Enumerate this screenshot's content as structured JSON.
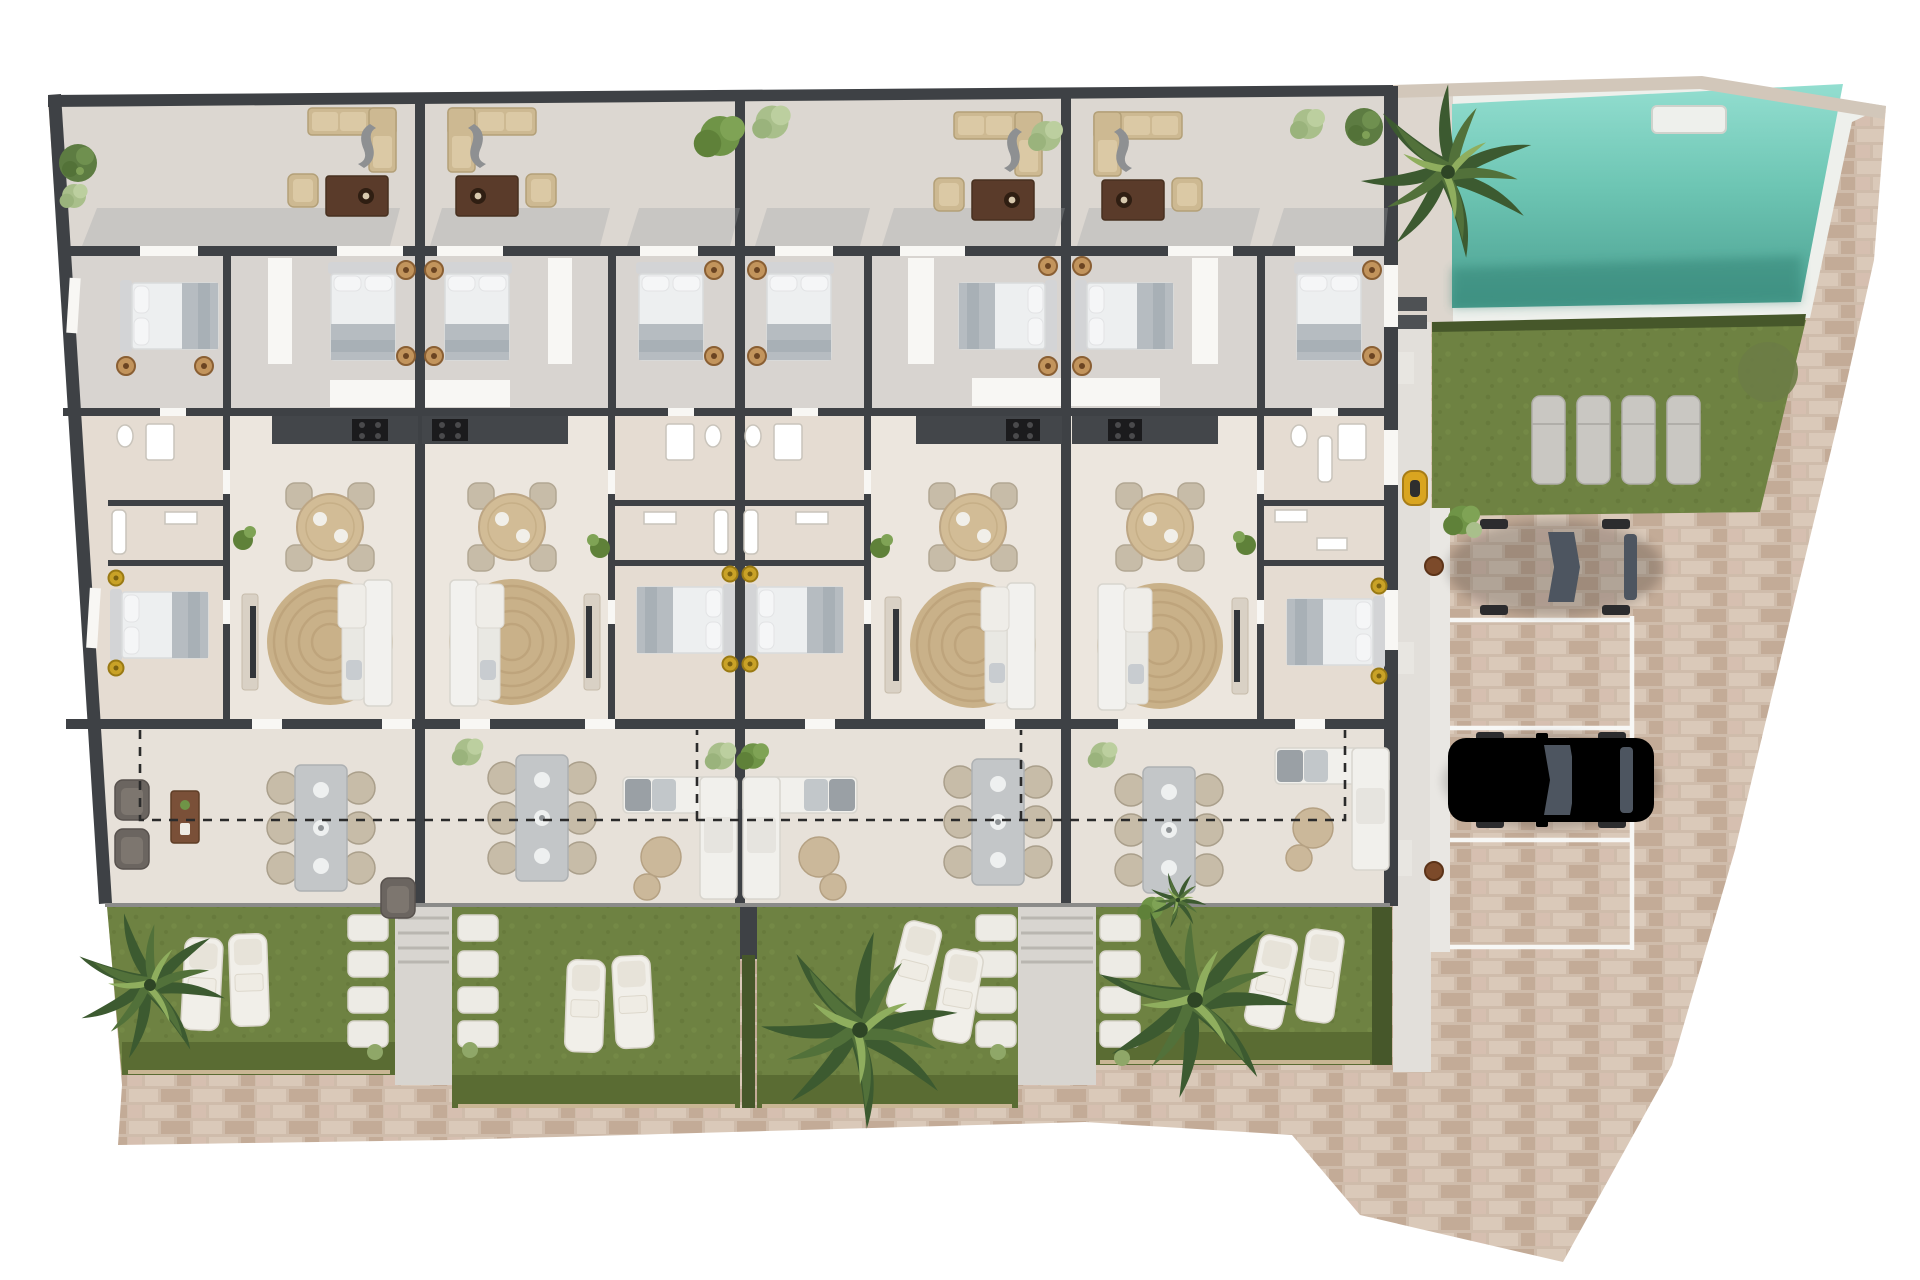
{
  "meta": {
    "title": "Residential development ground-floor plan — 3D top-down rendering",
    "view": "top-down",
    "text_visible": "none"
  },
  "site": {
    "units": 4,
    "areas": [
      {
        "name": "upper-terraces",
        "per_unit_items": [
          "outdoor-lounge-set",
          "shrubs"
        ]
      },
      {
        "name": "bedroom-row",
        "bedrooms": 8,
        "items": [
          "double-bed",
          "nightstand-lamps",
          "windows"
        ]
      },
      {
        "name": "bathroom-service-row",
        "items": [
          "shower",
          "toilet",
          "bathtub",
          "vanity"
        ]
      },
      {
        "name": "kitchen-living-dining",
        "per_unit_items": [
          "kitchen-counter-with-cooktop",
          "round-dining-table-4-chairs",
          "round-jute-rug",
          "white-corner-sofa",
          "tv-console",
          "potted-plant"
        ]
      },
      {
        "name": "guest-bedrooms",
        "bedrooms": 4
      },
      {
        "name": "lower-terraces",
        "per_unit_items": [
          "gray-dining-table-6-chairs",
          "outdoor-sofa-or-armchairs",
          "coffee-table"
        ],
        "boundary": "dashed-line"
      },
      {
        "name": "private-gardens",
        "count": 4,
        "sun_loungers": 8,
        "palm-trees": 3,
        "stepping-stone-paths": 4
      }
    ],
    "pool": {
      "water": "turquoise",
      "entry_step": 1,
      "lawn_loungers": 4,
      "palm_trees": 1
    },
    "parking": {
      "marked_spaces": 4,
      "vehicles": [
        {
          "type": "car",
          "color": "red"
        },
        {
          "type": "car",
          "color": "silver"
        },
        {
          "type": "scooter",
          "color": "yellow"
        }
      ],
      "surface": "brick-paving"
    },
    "perimeter": "brick-paved walkway, trapezoid site narrowing toward bottom-right"
  },
  "colors": {
    "wall": "#3e4145",
    "wallLight": "#8b8b89",
    "floorTerrace": "#dcd7d1",
    "floorBedroom": "#d8d4d0",
    "floorService": "#e5dcd2",
    "floorLiving": "#ece6de",
    "floorLower": "#e7e1d9",
    "floorWalkway": "#d8d5d0",
    "eastStrip": "#e2dfda",
    "brickBase": "#cfbcab",
    "brickA": "#dac9b9",
    "brickB": "#c3ab97",
    "brickC": "#d6bfb0",
    "poolTop": "#93ded0",
    "poolMid": "#6ec6b4",
    "poolBottom": "#4b9f90",
    "poolShadow": "#2f7e70",
    "coping": "#eef0ec",
    "copingTan": "#d2c7ba",
    "poolDeck": "#ddd6ce",
    "lawn": "#6e8242",
    "grassDark": "#5a6c33",
    "hedge": "#46572a",
    "fence": "#c9b694",
    "stone": "#edebe5",
    "white": "#f2f1ee",
    "sofaTan": "#cdb992",
    "woodDark": "#5a3b2a",
    "wood": "#7a5038",
    "rug": "#c9b189",
    "rattan": "#d2bc96",
    "chairTan": "#c7bca8",
    "grayTable": "#c3c6c8",
    "armchair": "#6b6560",
    "bedWhite": "#edeff0",
    "bedGray": "#b6bcc1",
    "headboard": "#d3d4d6",
    "counter": "#43464a",
    "cooktop": "#1b1b1d",
    "carRed": "#c13a40",
    "carSilver": "#d3d4d6",
    "glass": "#4d5560",
    "palmDark": "#3c5a30",
    "palmMid": "#52713a",
    "palmLight": "#8fae5e",
    "bushDark": "#6f9447",
    "bushLight": "#a9bf8b",
    "treeGreen": "#5d7c42",
    "gold": "#c9a227",
    "scooter": "#d9a520",
    "lineWhite": "#f7f7f5",
    "dashed": "#2b2b2b",
    "shadow": "#9fa2a6",
    "lamp": "#c2945c"
  }
}
